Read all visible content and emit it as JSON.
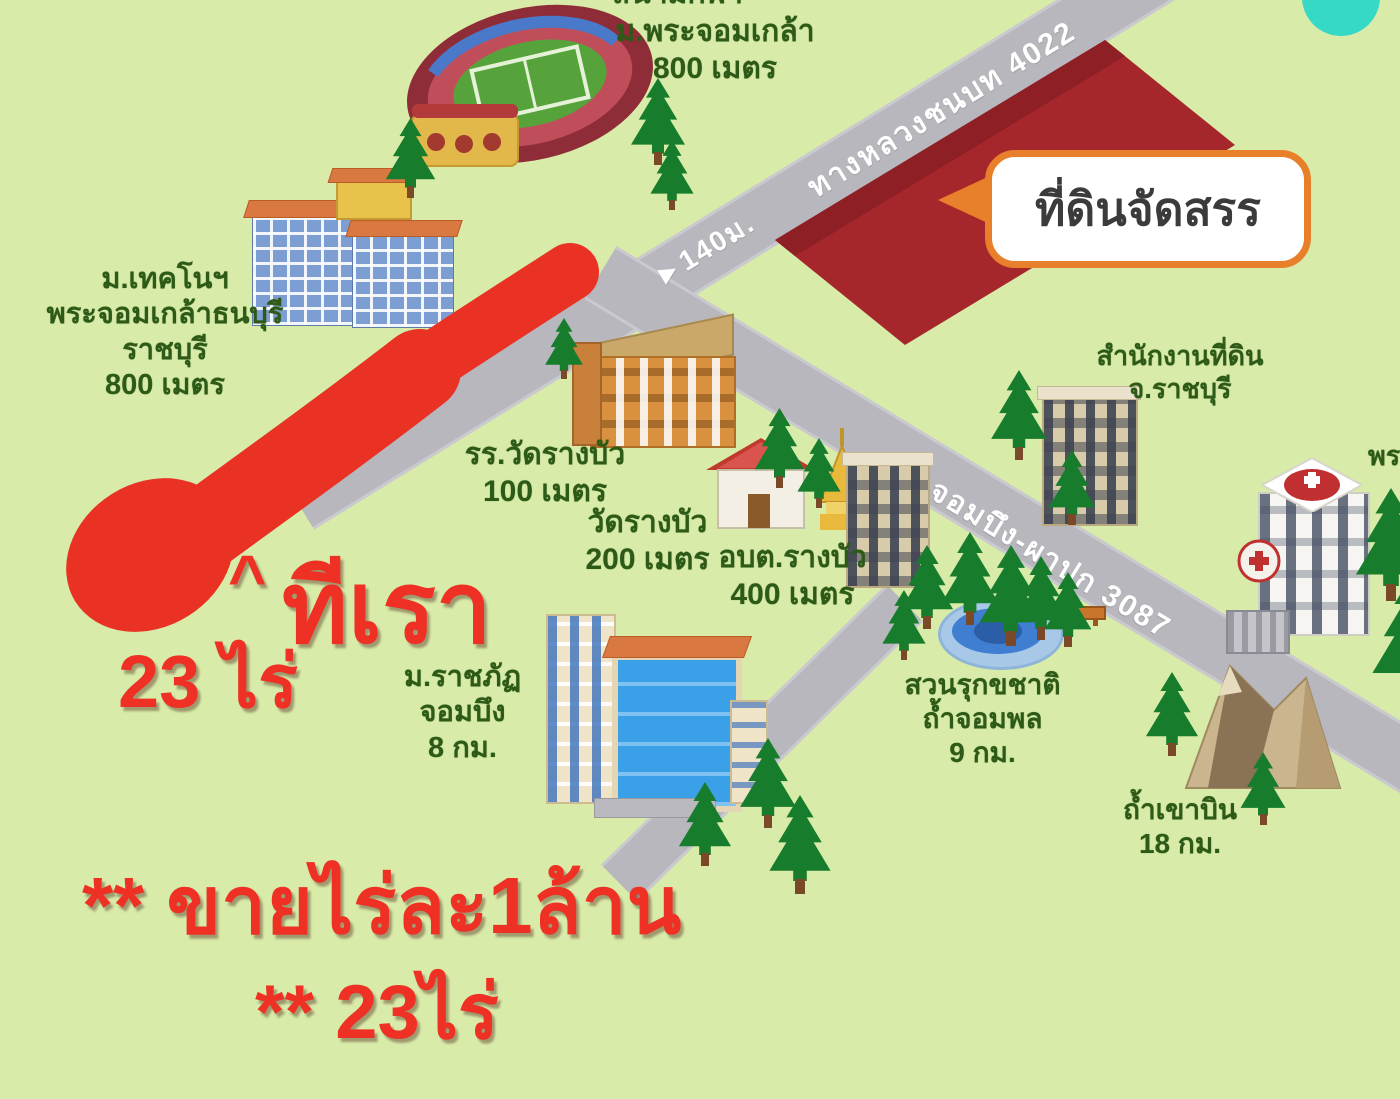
{
  "colors": {
    "background": "#d8eba9",
    "road": "#b7b7bd",
    "parcel_red": "#a5272c",
    "annotation_red": "#ee3124",
    "label_green": "#2d5a16",
    "callout_border": "#e87f2a",
    "callout_text": "#3b3b3b",
    "road_text": "#ffffff",
    "tree_green": "#177d2c",
    "pond_blue": "#3f7ed0",
    "teal_corner": "#35d9c6"
  },
  "map": {
    "callout": {
      "text": "ที่ดินจัดสรร"
    },
    "roads": {
      "highway_label": "ทางหลวงชนบท 4022",
      "distance_marker": "►140ม.",
      "chombueng_road_label": "ถ.จอมบึง-ผาปก 3087"
    },
    "places": {
      "stadium_partial": "สนามกีฬา",
      "stadium": {
        "line1": "ม.พระจอมเกล้า",
        "line2": "800 เมตร"
      },
      "kmutt": {
        "line1": "ม.เทคโนฯ",
        "line2": "พระจอมเกล้าธนบุรี",
        "line3": "ราชบุรี",
        "line4": "800 เมตร"
      },
      "school": {
        "line1": "รร.วัดรางบัว",
        "line2": "100 เมตร"
      },
      "temple": {
        "line1": "วัดรางบัว",
        "line2": "200 เมตร"
      },
      "sao": {
        "line1": "อบต.รางบัว",
        "line2": "400 เมตร"
      },
      "land_office": {
        "line1": "สำนักงานที่ดิน",
        "line2": "จ.ราชบุรี"
      },
      "rajabhat": {
        "line1": "ม.ราชภัฏ",
        "line2": "จอมบึง",
        "line3": "8 กม."
      },
      "arboretum": {
        "line1": "สวนรุกขชาติ",
        "line2": "ถ้ำจอมพล",
        "line3": "9 กม."
      },
      "cave": {
        "line1": "ถ้ำเขาบิน",
        "line2": "18 กม."
      },
      "edge_partial": "พร"
    },
    "annotations": {
      "caret": "^",
      "our_land": "ทีเรา",
      "area": "23 ไร่",
      "sale_line1": "** ขายไร่ละ1ล้าน",
      "sale_line2": "** 23ไร่"
    }
  }
}
